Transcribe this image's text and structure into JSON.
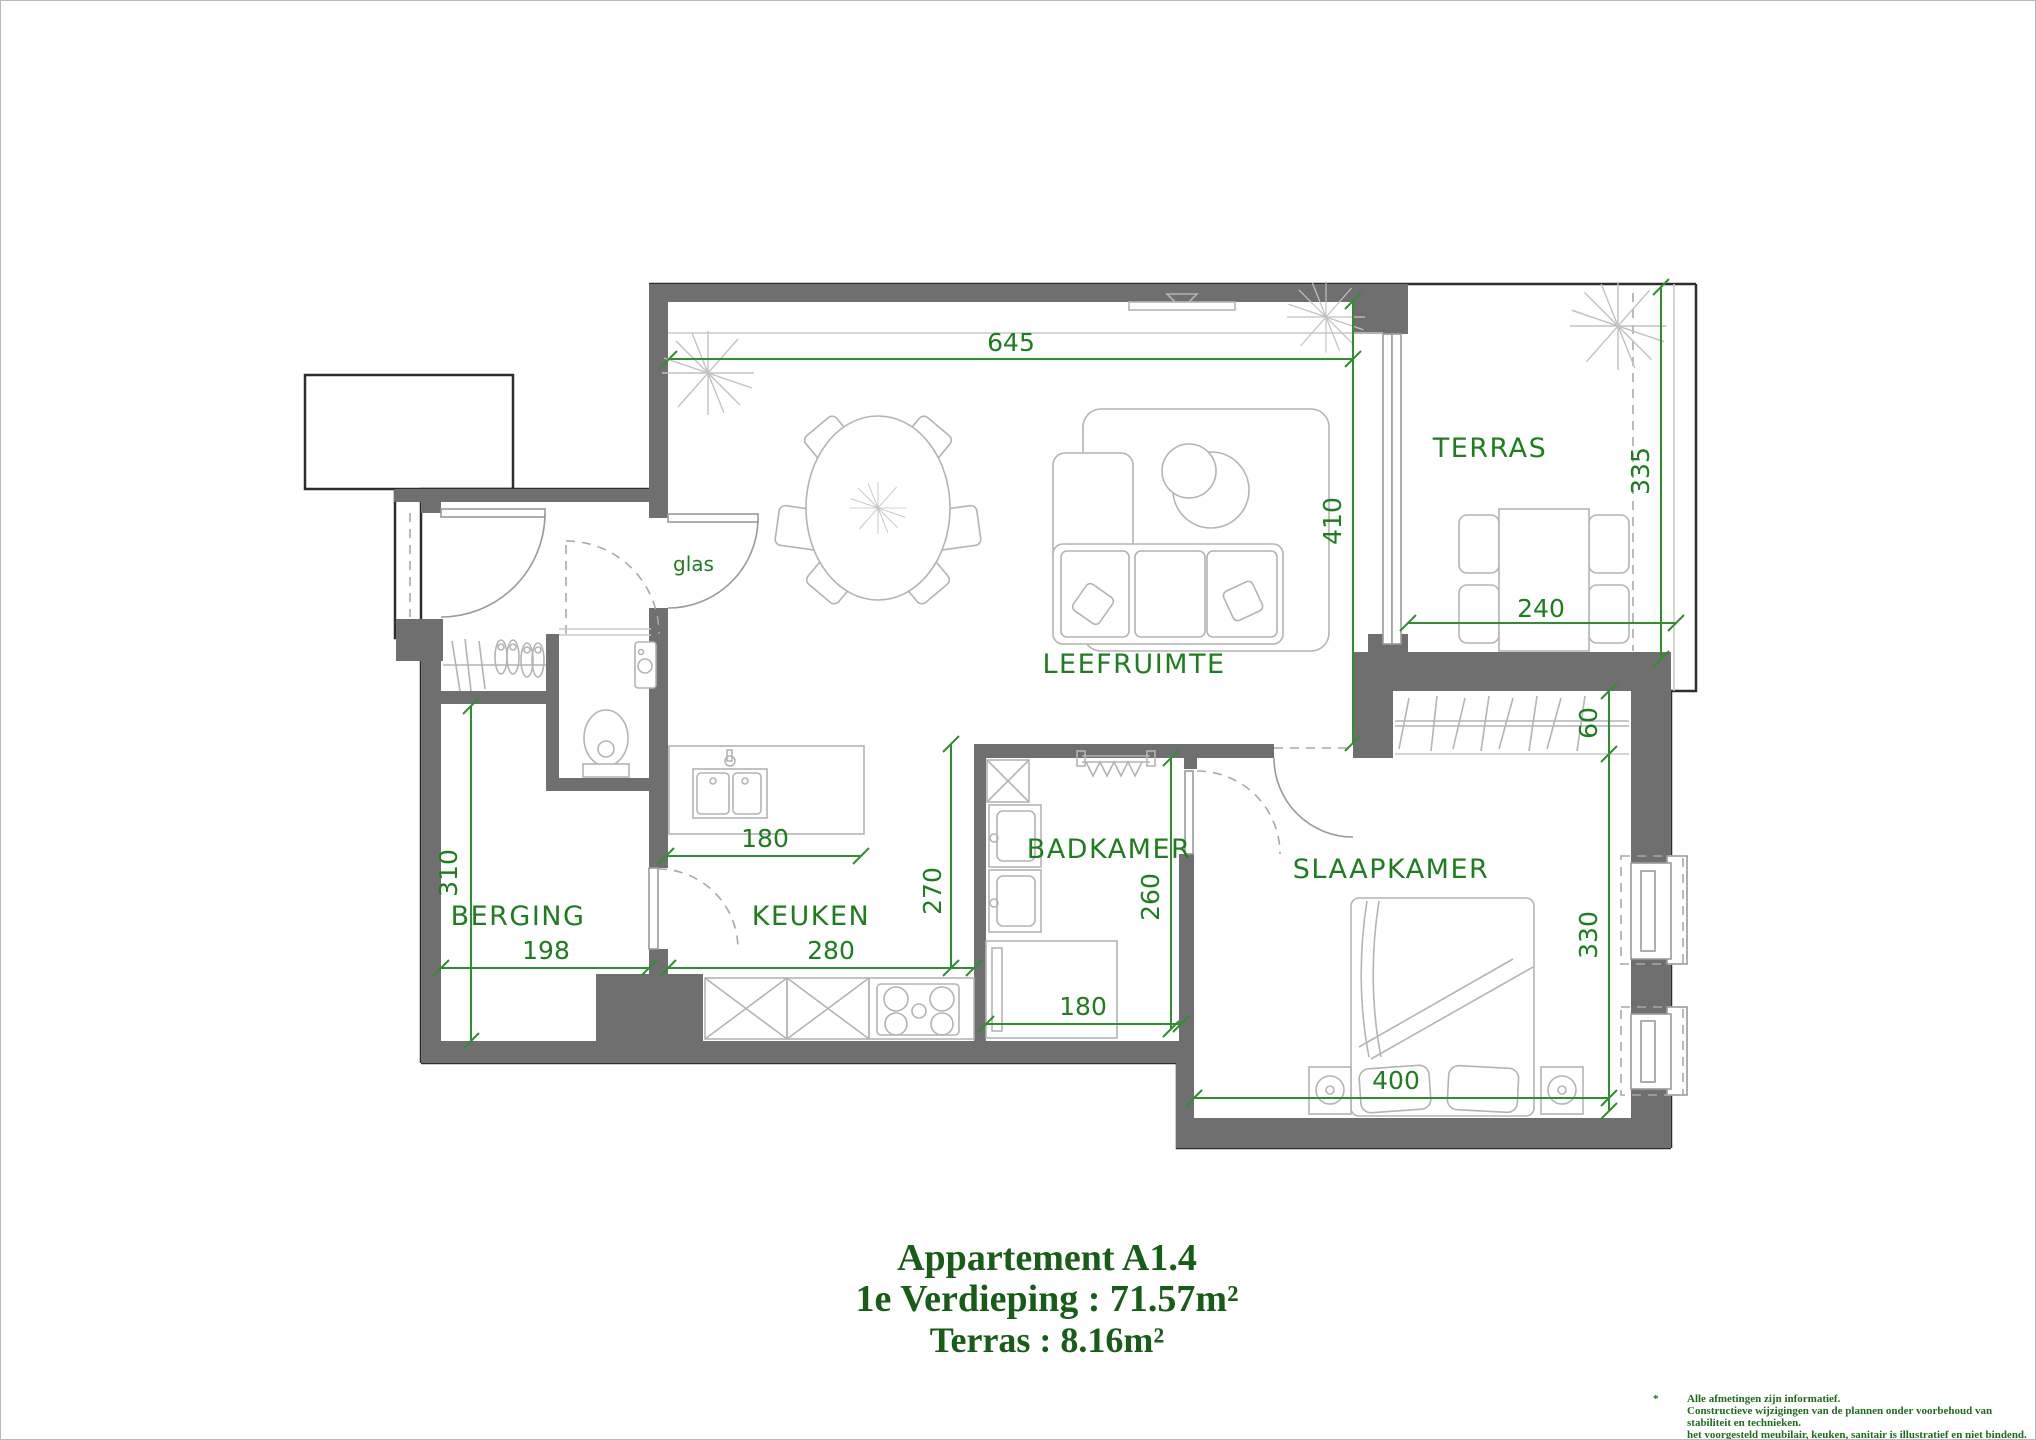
{
  "rooms": {
    "terras": "TERRAS",
    "leefruimte": "LEEFRUIMTE",
    "badkamer": "BADKAMER",
    "slaapkamer": "SLAAPKAMER",
    "berging": "BERGING",
    "keuken": "KEUKEN"
  },
  "labels": {
    "glass_door": "glas"
  },
  "dimensions": {
    "leefruimte_width": "645",
    "leefruimte_depth": "410",
    "terras_depth": "335",
    "terras_width": "240",
    "berging_depth": "310",
    "berging_width": "198",
    "keuken_island_width": "180",
    "keuken_depth": "270",
    "keuken_width": "280",
    "badkamer_depth": "260",
    "badkamer_width": "180",
    "slaapkamer_closet_depth": "60",
    "slaapkamer_depth": "330",
    "slaapkamer_width": "400"
  },
  "title": {
    "line1": "Appartement A1.4",
    "line2": "1e Verdieping : 71.57m²",
    "line3": "Terras : 8.16m²"
  },
  "footnote": {
    "marker": "*",
    "line1": "Alle afmetingen zijn informatief.",
    "line2": "Constructieve wijzigingen van de plannen onder voorbehoud van stabiliteit en technieken.",
    "line3": "het voorgesteld meubilair, keuken, sanitair is illustratief en niet bindend."
  },
  "colors": {
    "wall_fill": "#6f6f6f",
    "exterior_outline": "#2d2d2d",
    "furniture_line": "#b4b4b4",
    "dimension_green": "#2f8f2f",
    "label_green": "#1e7d1e",
    "title_green": "#175c17"
  }
}
